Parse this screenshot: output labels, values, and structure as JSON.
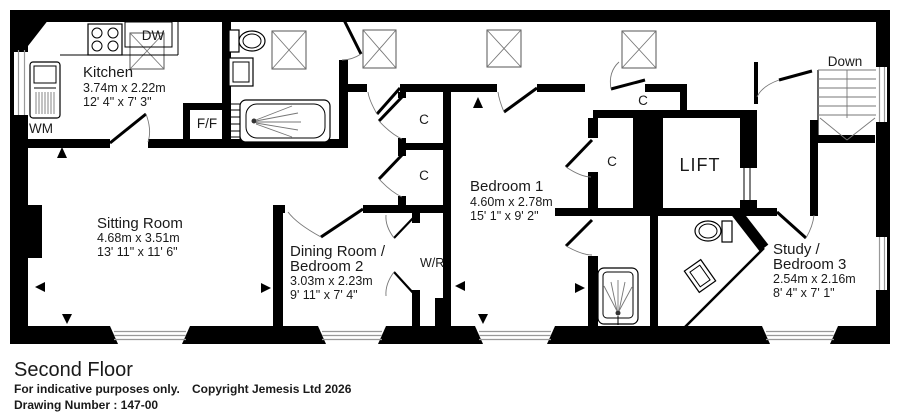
{
  "floor": {
    "rooms": {
      "kitchen": {
        "name": "Kitchen",
        "metric": "3.74m x 2.22m",
        "imperial": "12' 4\" x 7' 3\""
      },
      "sitting_room": {
        "name": "Sitting Room",
        "metric": "4.68m x 3.51m",
        "imperial": "13' 11\" x 11' 6\""
      },
      "dining_room": {
        "name_line1": "Dining Room /",
        "name_line2": "Bedroom 2",
        "metric": "3.03m x 2.23m",
        "imperial": "9' 11\" x 7' 4\""
      },
      "bedroom_1": {
        "name": "Bedroom 1",
        "metric": "4.60m x 2.78m",
        "imperial": "15' 1\" x 9' 2\""
      },
      "study": {
        "name_line1": "Study /",
        "name_line2": "Bedroom 3",
        "metric": "2.54m x 2.16m",
        "imperial": "8' 4\" x 7' 1\""
      }
    },
    "labels": {
      "lift": "LIFT",
      "stairs_down": "Down",
      "closet": "C",
      "wardrobe": "W/R",
      "dishwasher": "DW",
      "washing_machine": "WM",
      "fridge_freezer": "F/F"
    }
  },
  "footer": {
    "title": "Second Floor",
    "disclaimer": "For indicative purposes only.",
    "drawing_number": "Drawing Number : 147-00",
    "copyright": "Copyright Jemesis Ltd 2026"
  },
  "colors": {
    "wall": "#000000",
    "detail_line": "#777777",
    "background": "#ffffff"
  }
}
